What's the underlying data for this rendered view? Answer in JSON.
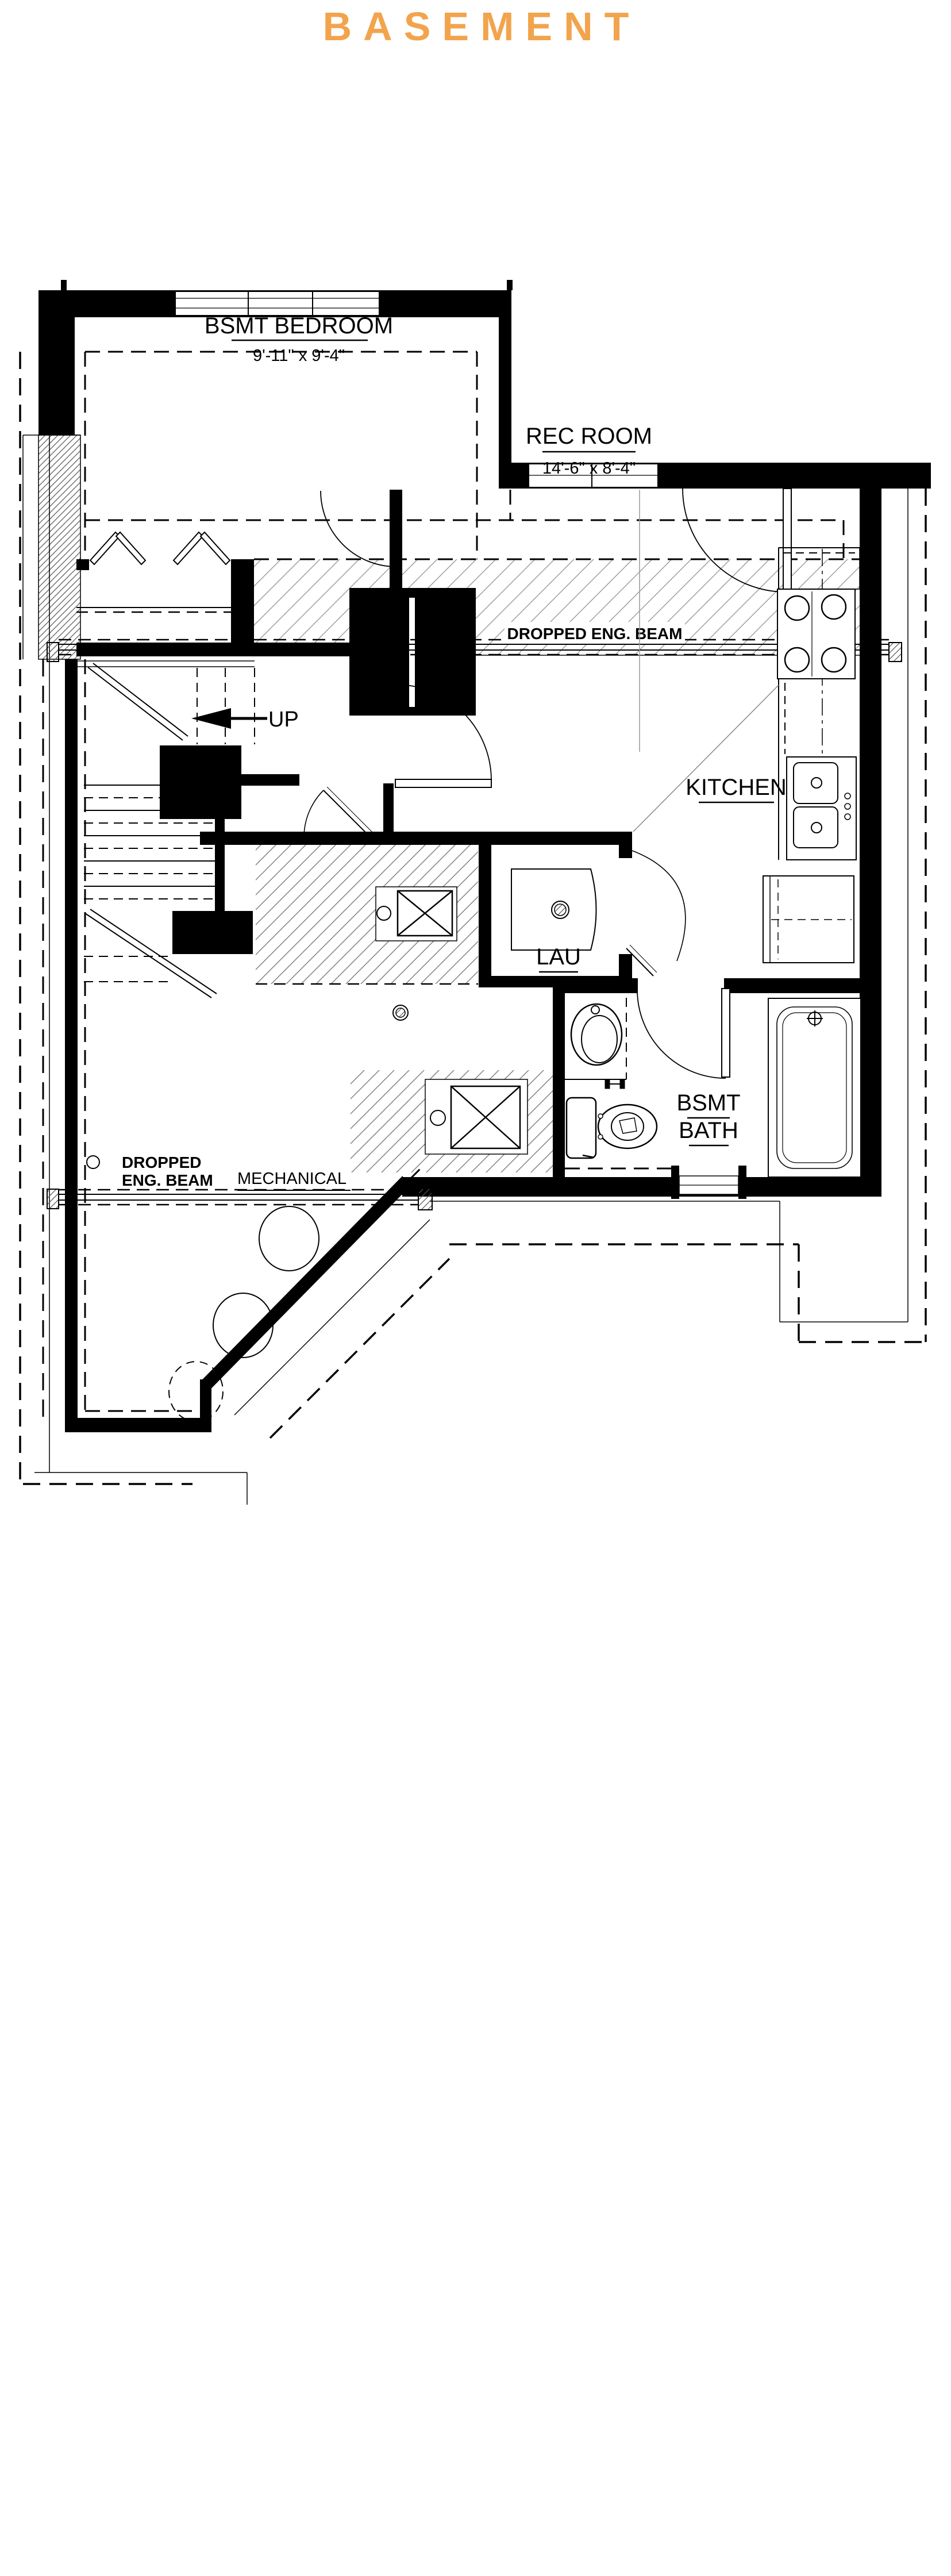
{
  "title": {
    "text": "BASEMENT"
  },
  "colors": {
    "accent": "#F2A44D",
    "line": "#000000"
  },
  "rooms": {
    "bedroom": {
      "name": "BSMT BEDROOM",
      "dims": "9'-11\" x 9'-4\""
    },
    "rec_room": {
      "name": "REC ROOM",
      "dims": "14'-6\" x 8'-4\""
    },
    "kitchen": {
      "name": "KITCHEN"
    },
    "laundry": {
      "name": "LAU"
    },
    "bath": {
      "name_line1": "BSMT",
      "name_line2": "BATH"
    },
    "mechanical": {
      "name": "MECHANICAL"
    }
  },
  "annotations": {
    "beam_upper": "DROPPED ENG. BEAM",
    "beam_lower_line1": "DROPPED",
    "beam_lower_line2": "ENG. BEAM",
    "stairs_up": "UP"
  },
  "icons": {
    "range": "range-burners-icon",
    "kitchen_sink": "double-sink-icon",
    "fridge": "fridge-icon",
    "washer": "washer-icon",
    "vanity_sink": "oval-sink-icon",
    "toilet": "toilet-icon",
    "bathtub": "bathtub-icon",
    "shower_roughin": "shower-roughin-icon",
    "floor_drain": "floor-drain-icon",
    "up_arrow": "up-arrow-icon"
  }
}
